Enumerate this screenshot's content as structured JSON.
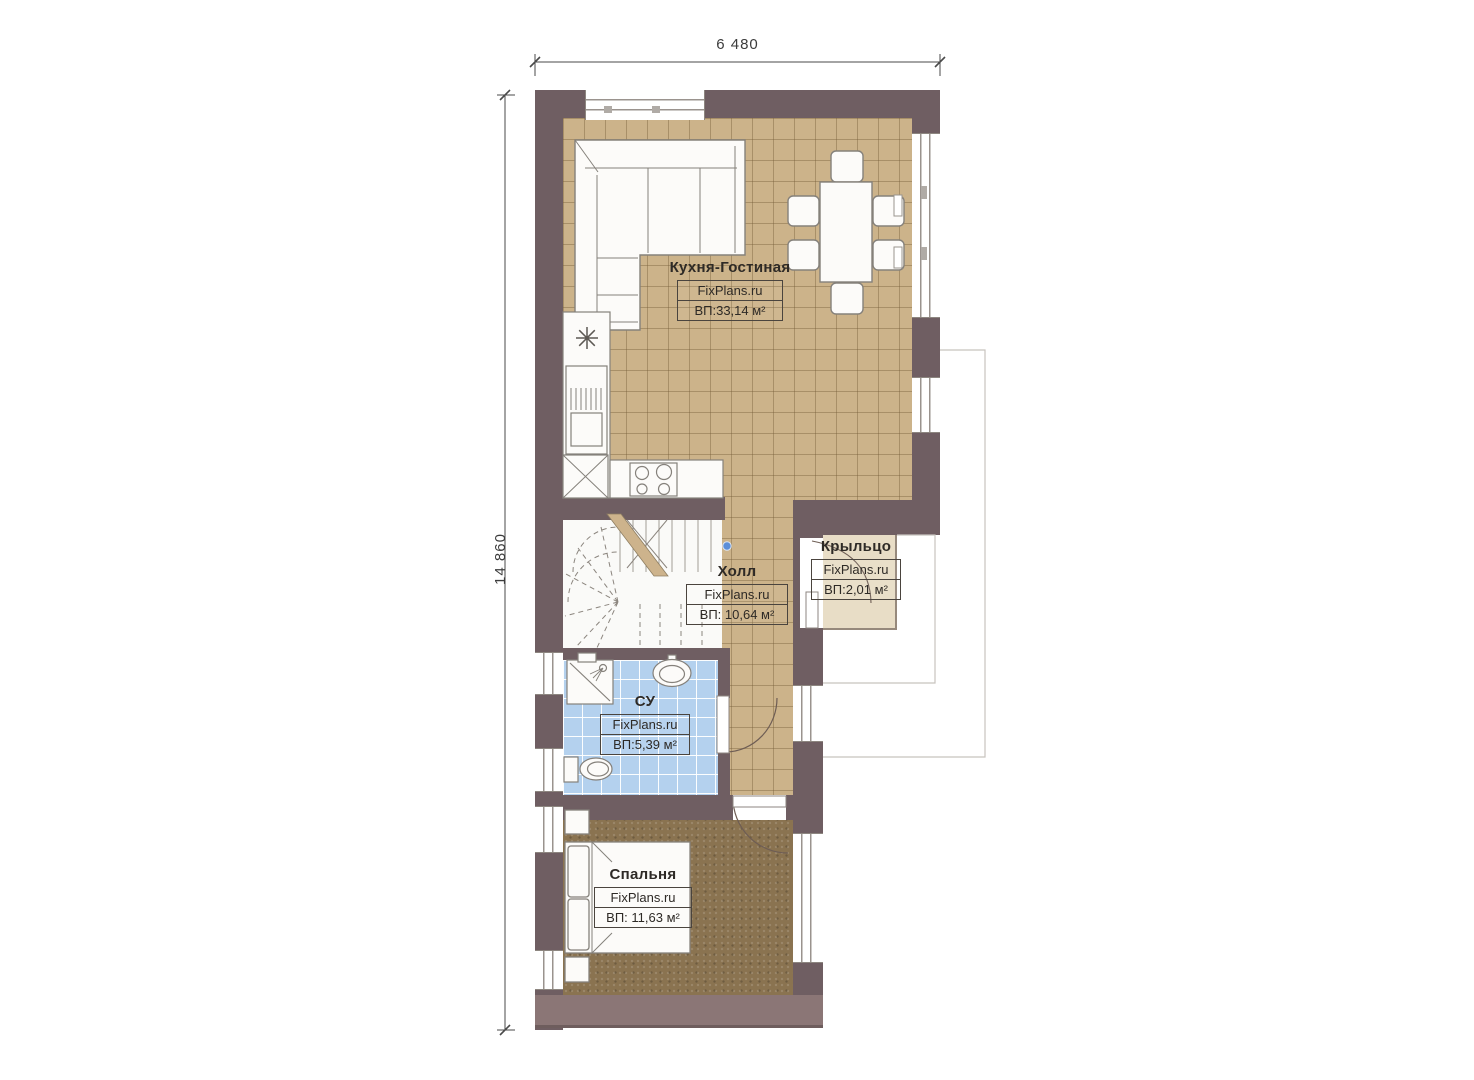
{
  "brand": "FixPlans.ru",
  "dimensions": {
    "width_label": "6 480",
    "height_label": "14 860"
  },
  "rooms": {
    "kitchen_living": {
      "name": "Кухня-Гостиная",
      "area": "ВП:33,14 м²"
    },
    "hall": {
      "name": "Холл",
      "area": "ВП: 10,64 м²"
    },
    "porch": {
      "name": "Крыльцо",
      "area": "ВП:2,01 м²"
    },
    "bathroom": {
      "name": "СУ",
      "area": "ВП:5,39 м²"
    },
    "bedroom": {
      "name": "Спальня",
      "area": "ВП: 11,63 м²"
    }
  },
  "colors": {
    "wall": "#6F5E62",
    "wall_bottom": "#8B7676",
    "floor_tile": "#CCB38A",
    "floor_bathroom": "#B4D1EE",
    "floor_bedroom": "#8A7350",
    "floor_porch": "#E8DDC6",
    "stair_marker_dot": "#5D8FD8"
  }
}
